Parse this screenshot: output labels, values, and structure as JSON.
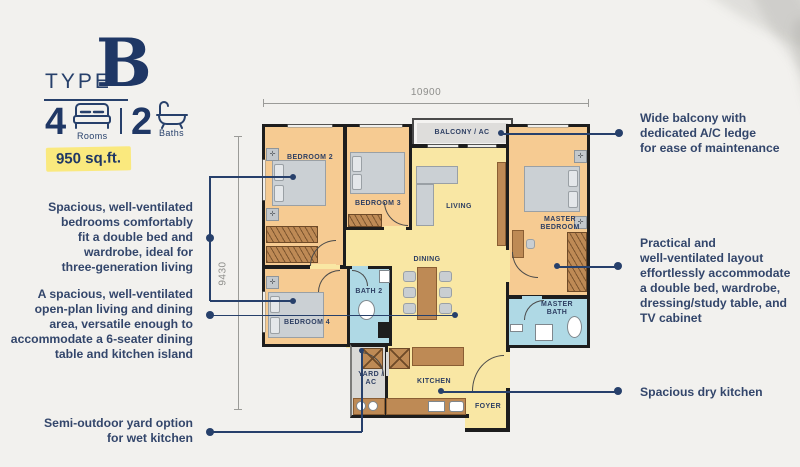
{
  "header": {
    "type_label": "TYPE",
    "type_letter": "B",
    "rooms_count": "4",
    "rooms_label": "Rooms",
    "baths_count": "2",
    "baths_label": "Baths",
    "area": "950 sq.ft."
  },
  "dimensions": {
    "top": "10900",
    "left": "9430"
  },
  "rooms": {
    "balcony": "BALCONY / AC",
    "bedroom2": "BEDROOM 2",
    "bedroom3": "BEDROOM 3",
    "living": "LIVING",
    "master_bedroom": "MASTER\nBEDROOM",
    "dining": "DINING",
    "bath2": "BATH 2",
    "bedroom4": "BEDROOM 4",
    "yard": "YARD /\nAC",
    "kitchen": "KITCHEN",
    "foyer": "FOYER",
    "master_bath": "MASTER\nBATH"
  },
  "annotations": {
    "left": [
      {
        "text": "Spacious, well-ventilated\nbedrooms comfortably\nfit a double bed and\nwardrobe, ideal for\nthree-generation living"
      },
      {
        "text": "A spacious, well-ventilated\nopen-plan living and dining\narea, versatile enough to\naccommodate a 6-seater dining\ntable and kitchen island"
      },
      {
        "text": "Semi-outdoor yard option\nfor wet kitchen"
      }
    ],
    "right": [
      {
        "text": "Wide balcony with\ndedicated A/C ledge\nfor ease of maintenance"
      },
      {
        "text": "Practical and\nwell-ventilated layout\neffortlessly accommodate\na double bed, wardrobe,\ndressing/study table, and\nTV cabinet"
      },
      {
        "text": "Spacious dry kitchen"
      }
    ]
  },
  "colors": {
    "navy": "#27406b",
    "title_navy": "#1f3765",
    "badge_yellow": "#fae97e",
    "bedroom_tan": "#f6cb92",
    "open_yellow": "#f9e7a4",
    "bath_blue": "#afd9e5",
    "balcony_gray": "#dedddb",
    "yard_gray": "#d9d9d6",
    "wall_black": "#1d1d1d",
    "furniture_brown": "#be8a55",
    "dimension_gray": "#9b9b98",
    "background": "#f2f1ee"
  }
}
